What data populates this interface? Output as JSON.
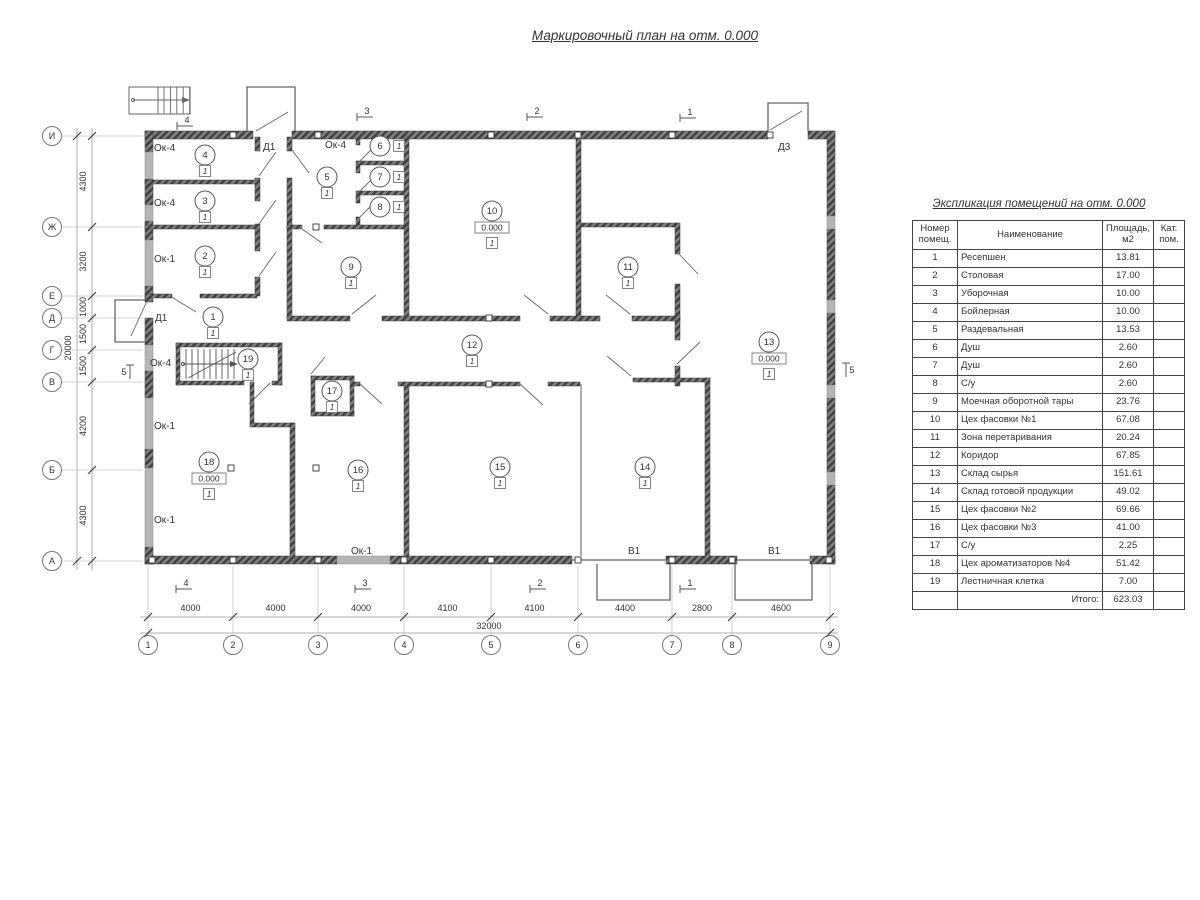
{
  "page": {
    "title": "Маркировочный план на отм. 0.000"
  },
  "plan": {
    "level_mark": "0.000",
    "floor_mark": "1",
    "col_axes": [
      "1",
      "2",
      "3",
      "4",
      "5",
      "6",
      "7",
      "8",
      "9"
    ],
    "col_dims": [
      "4000",
      "4000",
      "4000",
      "4100",
      "4100",
      "4400",
      "2800",
      "4600"
    ],
    "col_total": "32000",
    "row_axes": [
      "И",
      "Ж",
      "Е",
      "Д",
      "Г",
      "В",
      "Б",
      "А"
    ],
    "row_dims": [
      "4300",
      "3200",
      "1000",
      "1500",
      "1500",
      "4200",
      "4300"
    ],
    "row_total": "20000",
    "rooms": [
      {
        "n": "1"
      },
      {
        "n": "2"
      },
      {
        "n": "3"
      },
      {
        "n": "4"
      },
      {
        "n": "5"
      },
      {
        "n": "6"
      },
      {
        "n": "7"
      },
      {
        "n": "8"
      },
      {
        "n": "9"
      },
      {
        "n": "10",
        "level": "0.000"
      },
      {
        "n": "11"
      },
      {
        "n": "12"
      },
      {
        "n": "13",
        "level": "0.000"
      },
      {
        "n": "14"
      },
      {
        "n": "15"
      },
      {
        "n": "16"
      },
      {
        "n": "17"
      },
      {
        "n": "18",
        "level": "0.000"
      },
      {
        "n": "19"
      }
    ],
    "door_labels": [
      "Д1",
      "Д1",
      "Д3"
    ],
    "gate_labels": [
      "В1",
      "В1"
    ],
    "window_labels": [
      "Ок-4",
      "Ок-4",
      "Ок-1",
      "Ок-4",
      "Ок-4",
      "Ок-1",
      "Ок-1",
      "Ок-1"
    ],
    "section_marks_top": [
      "4",
      "3",
      "2",
      "1"
    ],
    "section_marks_bottom": [
      "4",
      "3",
      "2",
      "1"
    ],
    "section_marks_sides": [
      "5",
      "5"
    ]
  },
  "table": {
    "title": "Экспликация помещений на отм. 0.000",
    "headers": [
      "Номер помещ.",
      "Наименование",
      "Площадь, м2",
      "Кат. пом."
    ],
    "rows": [
      [
        "1",
        "Ресепшен",
        "13.81",
        ""
      ],
      [
        "2",
        "Столовая",
        "17.00",
        ""
      ],
      [
        "3",
        "Уборочная",
        "10.00",
        ""
      ],
      [
        "4",
        "Бойлерная",
        "10.00",
        ""
      ],
      [
        "5",
        "Раздевальная",
        "13.53",
        ""
      ],
      [
        "6",
        "Душ",
        "2.60",
        ""
      ],
      [
        "7",
        "Душ",
        "2.60",
        ""
      ],
      [
        "8",
        "С/у",
        "2.60",
        ""
      ],
      [
        "9",
        "Моечная оборотной тары",
        "23.76",
        ""
      ],
      [
        "10",
        "Цех фасовки №1",
        "67.08",
        ""
      ],
      [
        "11",
        "Зона перетаривания",
        "20.24",
        ""
      ],
      [
        "12",
        "Коридор",
        "67.85",
        ""
      ],
      [
        "13",
        "Склад сырья",
        "151.61",
        ""
      ],
      [
        "14",
        "Склад готовой продукции",
        "49.02",
        ""
      ],
      [
        "15",
        "Цех фасовки №2",
        "69.66",
        ""
      ],
      [
        "16",
        "Цех фасовки №3",
        "41.00",
        ""
      ],
      [
        "17",
        "С/у",
        "2.25",
        ""
      ],
      [
        "18",
        "Цех ароматизаторов №4",
        "51.42",
        ""
      ],
      [
        "19",
        "Лестничная клетка",
        "7.00",
        ""
      ]
    ],
    "total_label": "Итого:",
    "total_value": "623.03"
  }
}
